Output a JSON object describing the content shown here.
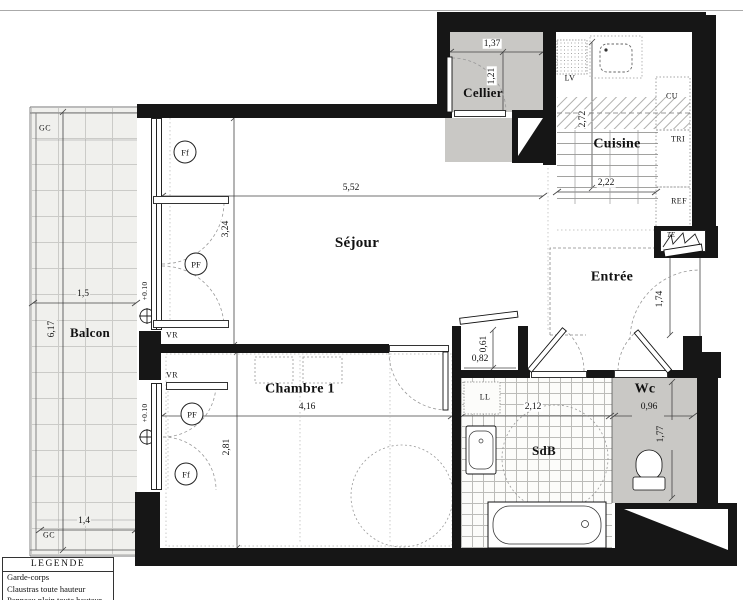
{
  "legend": {
    "header": "LEGENDE",
    "items": [
      "Garde-corps",
      "Claustras toute hauteur",
      "Panneau plein toute hauteur"
    ]
  },
  "rooms": {
    "balcon": "Balcon",
    "sejour": "Séjour",
    "chambre": "Chambre 1",
    "cellier": "Cellier",
    "cuisine": "Cuisine",
    "entree": "Entrée",
    "sdb": "SdB",
    "wc": "Wc"
  },
  "dimensions": {
    "sejour_width": "5,52",
    "sejour_depth": "3,24",
    "chambre_width": "4,16",
    "chambre_depth": "2,81",
    "balcon_depth": "6,17",
    "balcon_width_top": "1,5",
    "balcon_width_bottom": "1,4",
    "cellier_width": "1,37",
    "cellier_depth": "1,21",
    "cuisine_depth": "2,72",
    "cuisine_width": "2,22",
    "entree_depth": "1,74",
    "placard_depth": "0,61",
    "placard_width": "0,82",
    "sdb_width": "2,12",
    "wc_width": "0,96",
    "wc_depth": "1,77"
  },
  "annotations": {
    "gc_top": "GC",
    "gc_bottom": "GC",
    "vr_sejour": "VR",
    "vr_chambre": "VR",
    "ff_sejour": "Ff",
    "pf_sejour": "PF",
    "pf_chambre": "PF",
    "ff_chambre": "Ff",
    "level_sejour": "+0.10",
    "level_chambre": "+0.10",
    "lv": "LV",
    "cu": "CU",
    "tri": "TRI",
    "ref": "REF",
    "te": "TE",
    "ll": "LL"
  },
  "colors": {
    "wall": "#161616",
    "shaded_room": "#c9c8c5",
    "balcony_floor": "#f0f0ed"
  }
}
